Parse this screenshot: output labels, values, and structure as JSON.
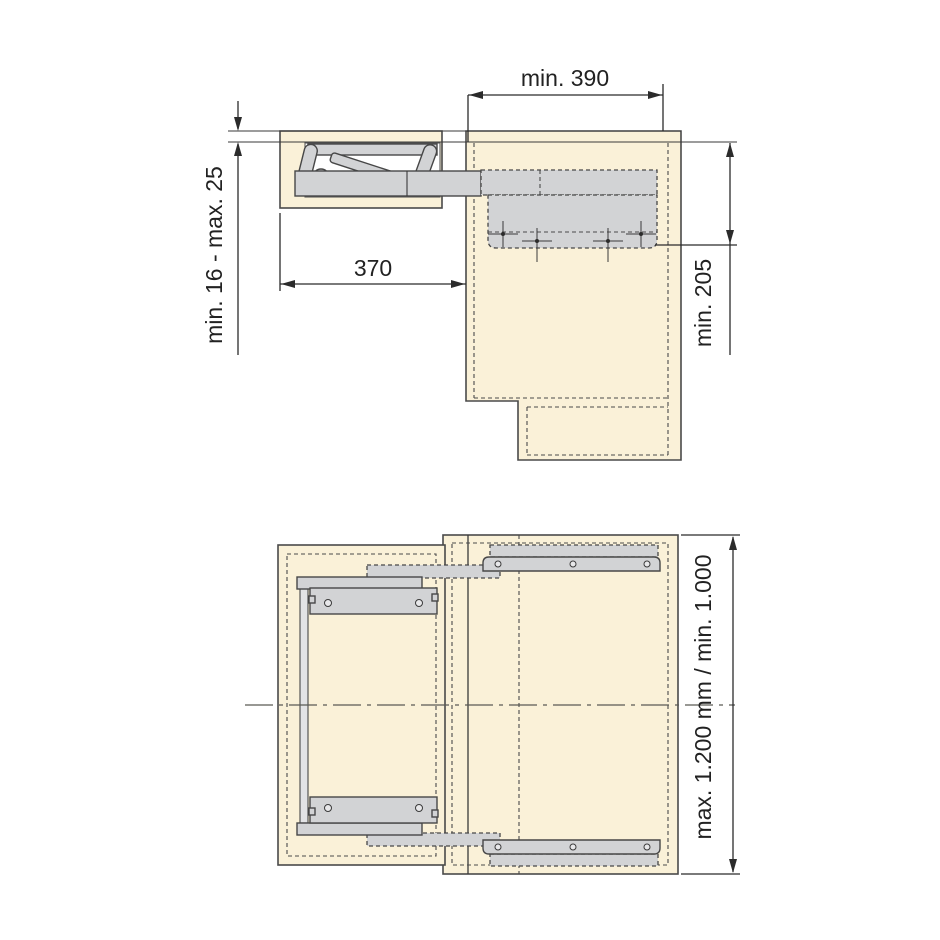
{
  "figure": {
    "type": "technical-installation-drawing",
    "description": "Pull-out folding table fitting: side section view (top) and plan view (bottom) with installation dimensions",
    "colors": {
      "background": "#ffffff",
      "panel_fill": "#faf1d8",
      "hardware_fill": "#d2d3d5",
      "line_color": "#3a3a3a",
      "text_color": "#222222"
    },
    "side_view": {
      "dim_top_width": "min. 390",
      "dim_panel_thickness": "min. 16 - max. 25",
      "dim_mechanism_depth": "370",
      "dim_side_height": "min. 205"
    },
    "plan_view": {
      "dim_cabinet_length": "max. 1.200 mm / min. 1.000"
    }
  }
}
